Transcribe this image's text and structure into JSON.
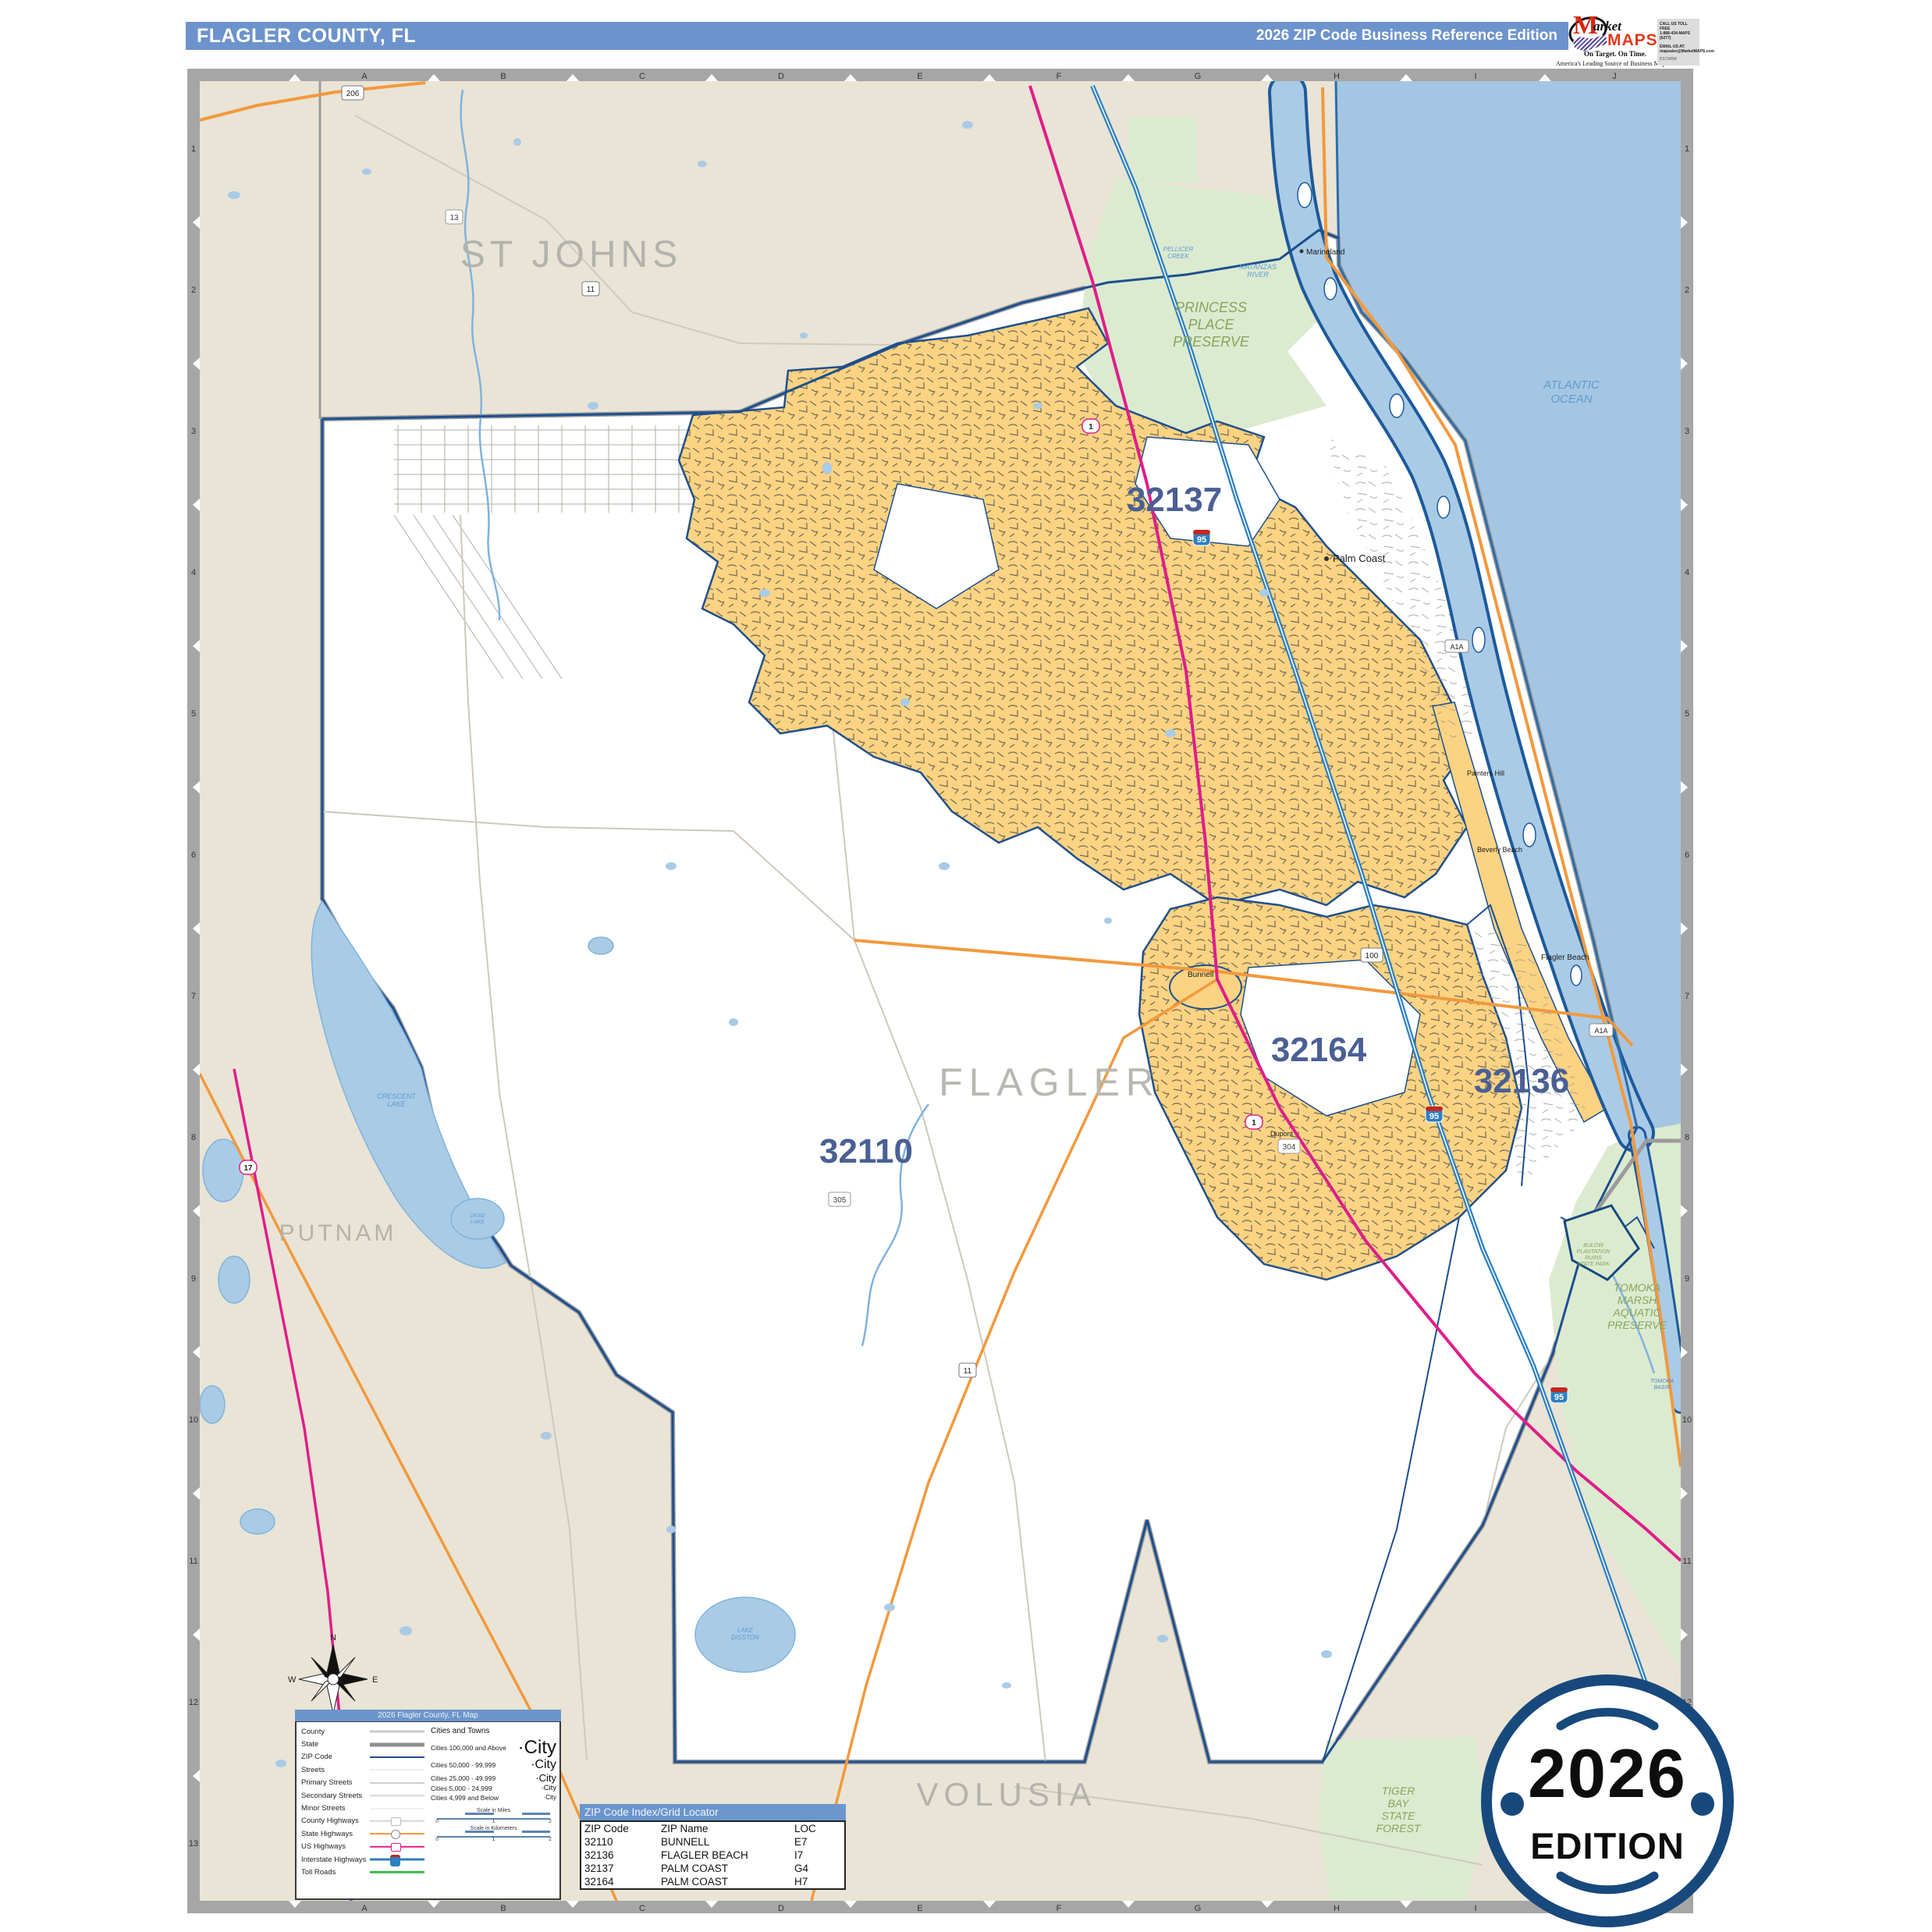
{
  "header": {
    "title": "FLAGLER COUNTY, FL",
    "edition": "2026 ZIP Code Business Reference Edition"
  },
  "logo": {
    "m": "M",
    "arket": "arket",
    "maps": "MAPS",
    "tagline": "On Target.  On Time.",
    "subtitle": "America's Leading Source of  Business Maps",
    "call": "CALL US TOLL FREE",
    "phone": "1-888-434-MAPS (6277)",
    "email_label": "EMAIL US AT:",
    "email": "mapsales@MarketMAPS.com",
    "product_code": "D17345M"
  },
  "badge": {
    "year": "2026",
    "edition": "EDITION"
  },
  "grid": {
    "columns": [
      "A",
      "B",
      "C",
      "D",
      "E",
      "F",
      "G",
      "H",
      "I",
      "J"
    ],
    "rows": [
      "1",
      "2",
      "3",
      "4",
      "5",
      "6",
      "7",
      "8",
      "9",
      "10",
      "11",
      "12",
      "13"
    ]
  },
  "compass": {
    "n": "N",
    "e": "E",
    "s": "S",
    "w": "W"
  },
  "map": {
    "counties": {
      "st_johns": "ST JOHNS",
      "flagler": "FLAGLER",
      "putnam": "PUTNAM",
      "volusia": "VOLUSIA"
    },
    "zips": {
      "z32137": "32137",
      "z32110": "32110",
      "z32164": "32164",
      "z32136": "32136"
    },
    "cities": {
      "palm_coast": "Palm Coast",
      "marineland": "Marineland",
      "painters_hill": "Painters Hill",
      "beverly_beach": "Beverly Beach",
      "flagler_beach": "Flagler Beach",
      "bunnell": "Bunnell",
      "dupont": "Dupont"
    },
    "water": {
      "ocean": [
        "ATLANTIC",
        "OCEAN"
      ],
      "matanzas": [
        "MATANZAS",
        "RIVER"
      ],
      "pellicer": [
        "PELLICER",
        "CREEK"
      ],
      "crescent": [
        "CRESCENT",
        "LAKE"
      ],
      "dead": [
        "DEAD",
        "LAKE"
      ],
      "disston": [
        "LAKE",
        "DISSTON"
      ],
      "tomoka_basin": [
        "TOMOKA",
        "BASIN"
      ]
    },
    "parks": {
      "princess": [
        "PRINCESS",
        "PLACE",
        "PRESERVE"
      ],
      "tomoka": [
        "TOMOKA",
        "MARSH",
        "AQUATIC",
        "PRESERVE"
      ],
      "bulow": [
        "BULOW",
        "PLANTATION",
        "RUINS",
        "STATE PARK"
      ],
      "tiger": [
        "TIGER",
        "BAY",
        "STATE",
        "FOREST"
      ]
    },
    "shields": {
      "i95": "95",
      "us1": "1",
      "us17": "17",
      "sr100": "100",
      "sr11": "11",
      "sr206": "206",
      "cr305": "305",
      "cr304": "304",
      "cr13": "13",
      "a1a": "A1A"
    }
  },
  "legend": {
    "title": "2026 Flagler County, FL Map",
    "road_items": [
      {
        "label": "County",
        "type": "county"
      },
      {
        "label": "State",
        "type": "state"
      },
      {
        "label": "ZIP Code",
        "type": "zip"
      },
      {
        "label": "Streets",
        "type": "street"
      },
      {
        "label": "Primary Streets",
        "type": "primary"
      },
      {
        "label": "Secondary Streets",
        "type": "secondary"
      },
      {
        "label": "Minor Streets",
        "type": "minor"
      },
      {
        "label": "County Highways",
        "type": "cty_hwy"
      },
      {
        "label": "State Highways",
        "type": "st_hwy"
      },
      {
        "label": "US Highways",
        "type": "us_hwy"
      },
      {
        "label": "Interstate Highways",
        "type": "int_hwy"
      },
      {
        "label": "Toll Roads",
        "type": "toll"
      }
    ],
    "cities_header": "Cities and Towns",
    "city_sample": "City",
    "city_classes": [
      "Cities 100,000 and Above",
      "Cities 50,000 - 99,999",
      "Cities 25,000 - 49,999",
      "Cities 5,000 - 24,999",
      "Cities 4,999 and Below"
    ],
    "scale_miles": "Scale in Miles",
    "scale_km": "Scale in Kilometers",
    "scale_ticks": [
      "0",
      "1",
      "2"
    ]
  },
  "zip_table": {
    "title": "ZIP Code Index/Grid Locator",
    "columns": [
      "ZIP Code",
      "ZIP Name",
      "LOC"
    ],
    "rows": [
      [
        "32110",
        "BUNNELL",
        "E7"
      ],
      [
        "32136",
        "FLAGLER BEACH",
        "I7"
      ],
      [
        "32137",
        "PALM COAST",
        "G4"
      ],
      [
        "32164",
        "PALM COAST",
        "H7"
      ]
    ]
  },
  "colors": {
    "header_blue": "#6d93cc",
    "zip_yellow": "#fbd382",
    "land_beige": "#e9e4d5",
    "ocean_blue": "#a5c6e2",
    "boundary_blue": "#1d4f8f",
    "zip_label_blue": "#4a5f94",
    "park_green": "#dcead0",
    "us_hwy_pink": "#df1e8a",
    "state_hwy_orange": "#f2993d",
    "interstate_blue": "#2e7fc1",
    "toll_green": "#3cb54a",
    "badge_navy": "#17497c"
  }
}
